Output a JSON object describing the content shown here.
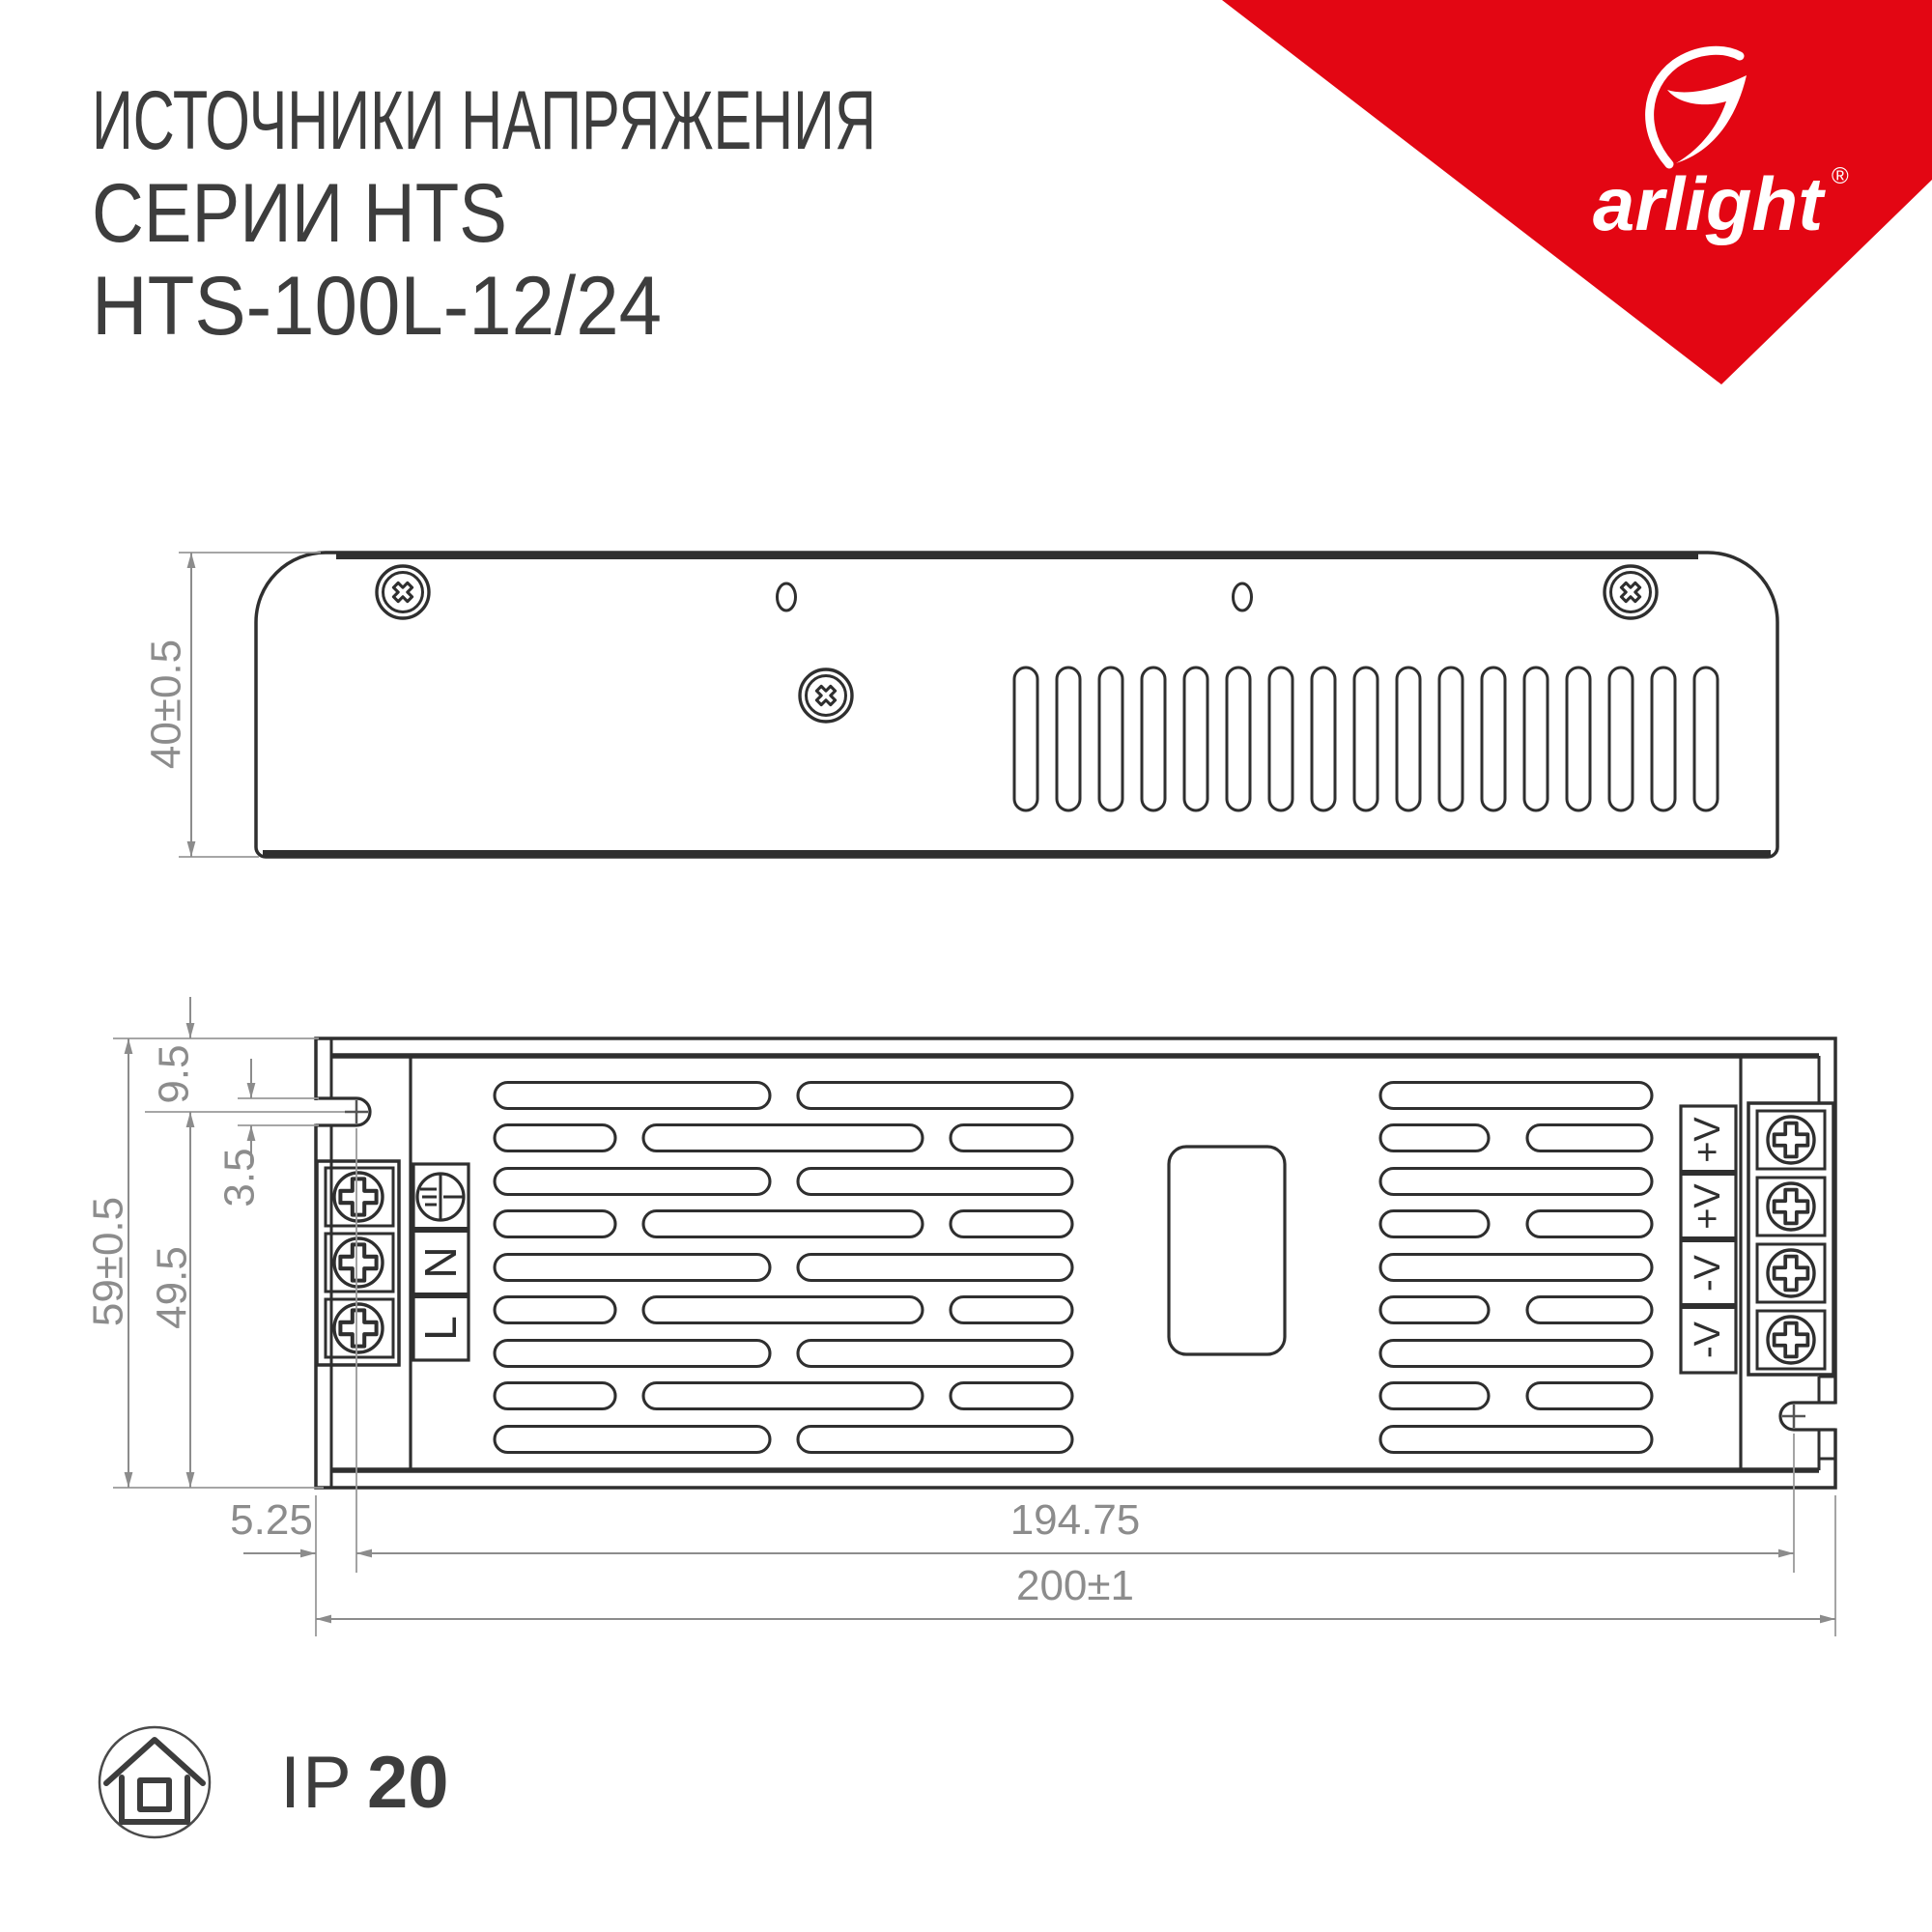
{
  "title": {
    "line1": "ИСТОЧНИКИ НАПРЯЖЕНИЯ",
    "line2": "СЕРИИ HTS",
    "line3": "HTS-100L-12/24"
  },
  "brand": {
    "name": "arlight",
    "registered": "®"
  },
  "dimensions": {
    "top_view_height": "40±0.5",
    "front_overall_height": "59±0.5",
    "front_body_height": "49.5",
    "flange_slot_offset": "9.5",
    "slot_width": "3.5",
    "keyhole_offset": "5.25",
    "mount_hole_distance": "194.75",
    "overall_length": "200±1"
  },
  "terminals": {
    "input": [
      "N",
      "L"
    ],
    "output": [
      "+V",
      "+V",
      "-V",
      "-V"
    ]
  },
  "ip_rating": {
    "prefix": "IP",
    "value": "20"
  },
  "colors": {
    "brand_red": "#e30613",
    "line_dark": "#2f2f2f",
    "dim_gray": "#8c8c8c"
  }
}
